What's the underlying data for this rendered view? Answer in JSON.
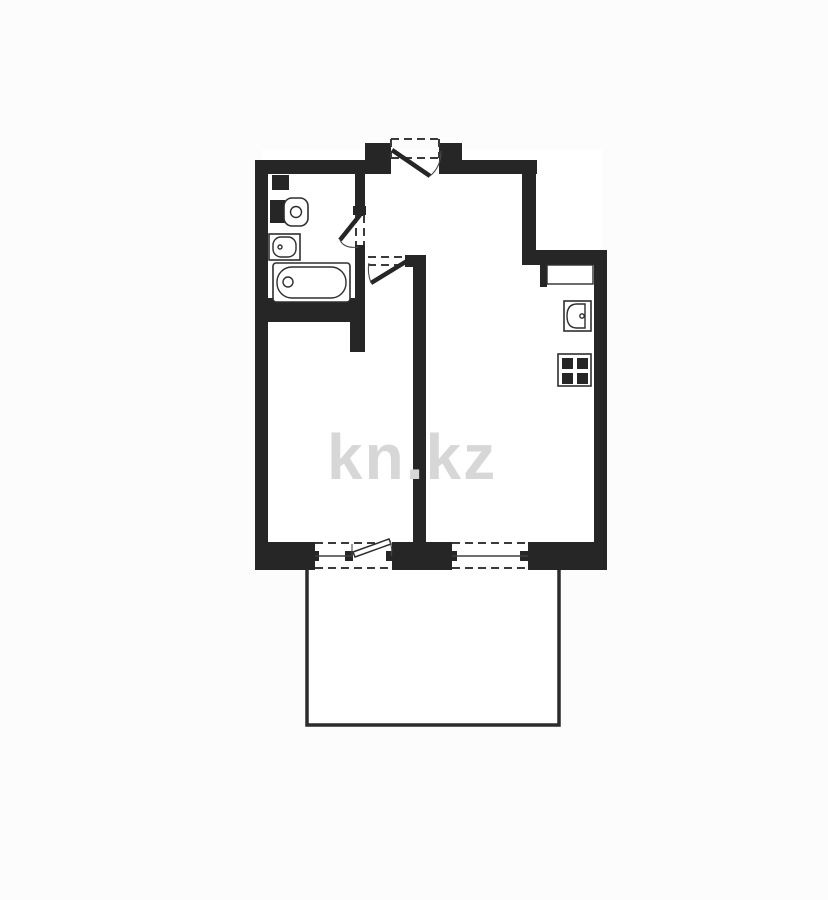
{
  "watermark": {
    "text": "kn.kz"
  },
  "colors": {
    "wall": "#262626",
    "background": "#fcfcfc",
    "line": "#2e2e2e",
    "watermark": "#d7d7d7"
  },
  "plan": {
    "kind": "apartment-floor-plan",
    "fixtures": [
      "toilet",
      "bathroom-sink",
      "bathtub",
      "kitchen-sink",
      "stove",
      "kitchen-niche"
    ],
    "doors": [
      "entrance-door",
      "bathroom-door",
      "bedroom-door",
      "balcony-door"
    ],
    "windows": [
      "bedroom-window",
      "living-room-window"
    ],
    "outdoor": [
      "balcony"
    ]
  }
}
